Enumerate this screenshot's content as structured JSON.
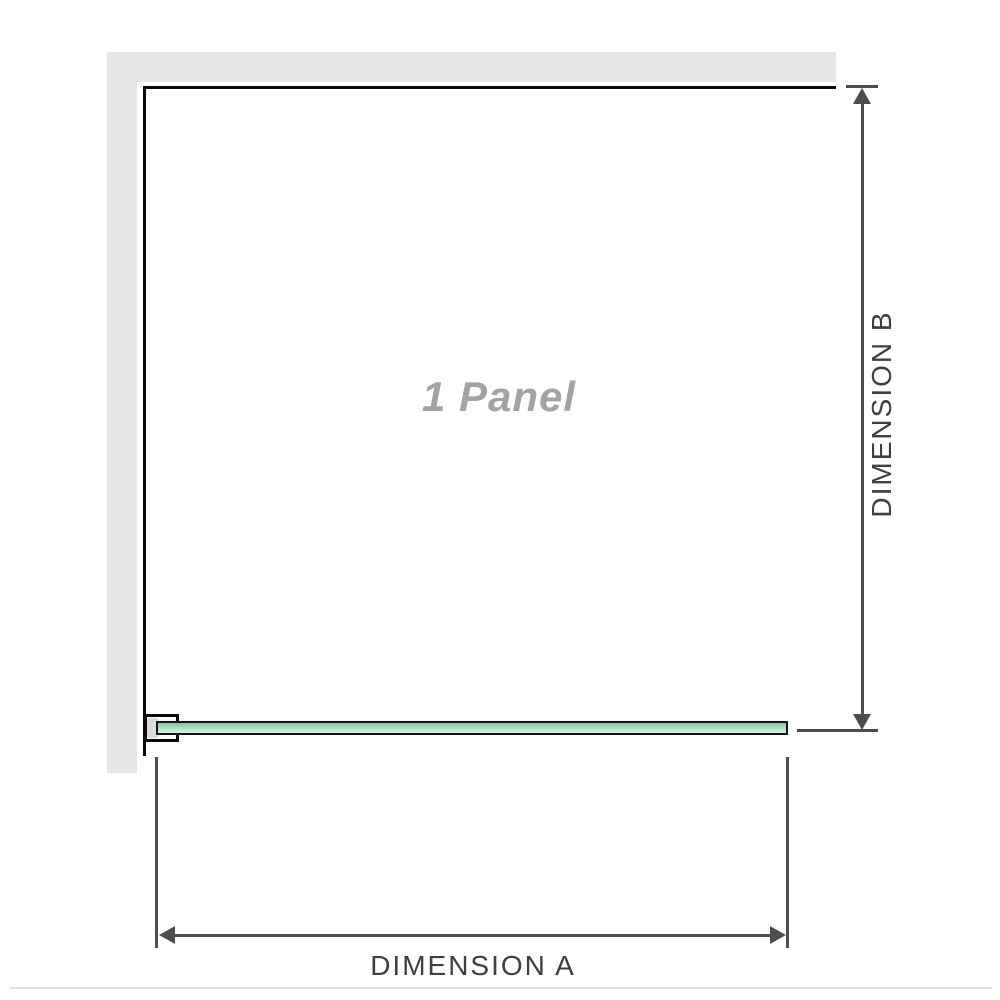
{
  "diagram": {
    "panel_label": "1 Panel",
    "dimension_a": {
      "label": "DIMENSION A"
    },
    "dimension_b": {
      "label": "DIMENSION B"
    },
    "colors": {
      "wall_fill": "#e6e6e6",
      "outline": "#0a0a0a",
      "dimension_line": "#4d4d4d",
      "label_text": "#3f3f3f",
      "panel_label_text": "#a3a3a3",
      "glass_green_dark": "#82c5a2",
      "glass_green_light": "#dbf1e5",
      "glass_border": "#161616",
      "gasket_fill": "#dcdcdc",
      "footer_line": "#dfe3dc"
    }
  }
}
